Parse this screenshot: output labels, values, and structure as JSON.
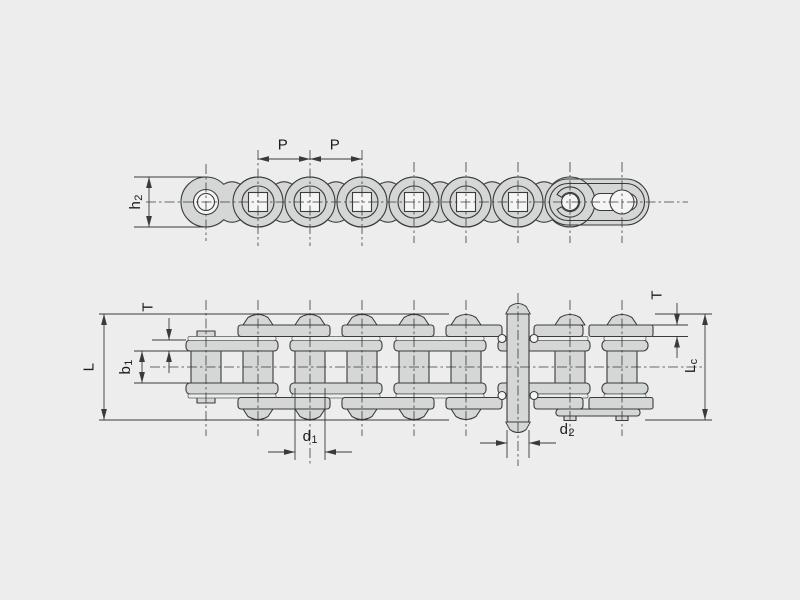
{
  "diagram_type": "roller-chain-engineering-drawing",
  "colors": {
    "background": "#ededee",
    "line": "#3b3b3b",
    "plate_fill": "#d5d6d6",
    "bushing_fill": "#e9eef1",
    "hole_fill": "#f5f5f5",
    "text": "#1c1c1c"
  },
  "side_view": {
    "name": "chain-side-view",
    "pitch_label_1": "P",
    "pitch_label_2": "P",
    "plate_height": {
      "main": "h",
      "sub": "2"
    }
  },
  "top_view": {
    "name": "chain-plan-view",
    "thickness_left": "T",
    "thickness_right": "T",
    "inner_width": {
      "main": "b",
      "sub": "1"
    },
    "pin_length": "L",
    "connecting_pin_length": {
      "main": "L",
      "sub": "c"
    },
    "roller_diameter": {
      "main": "d",
      "sub": "1"
    },
    "pin_diameter": {
      "main": "d",
      "sub": "2"
    }
  }
}
